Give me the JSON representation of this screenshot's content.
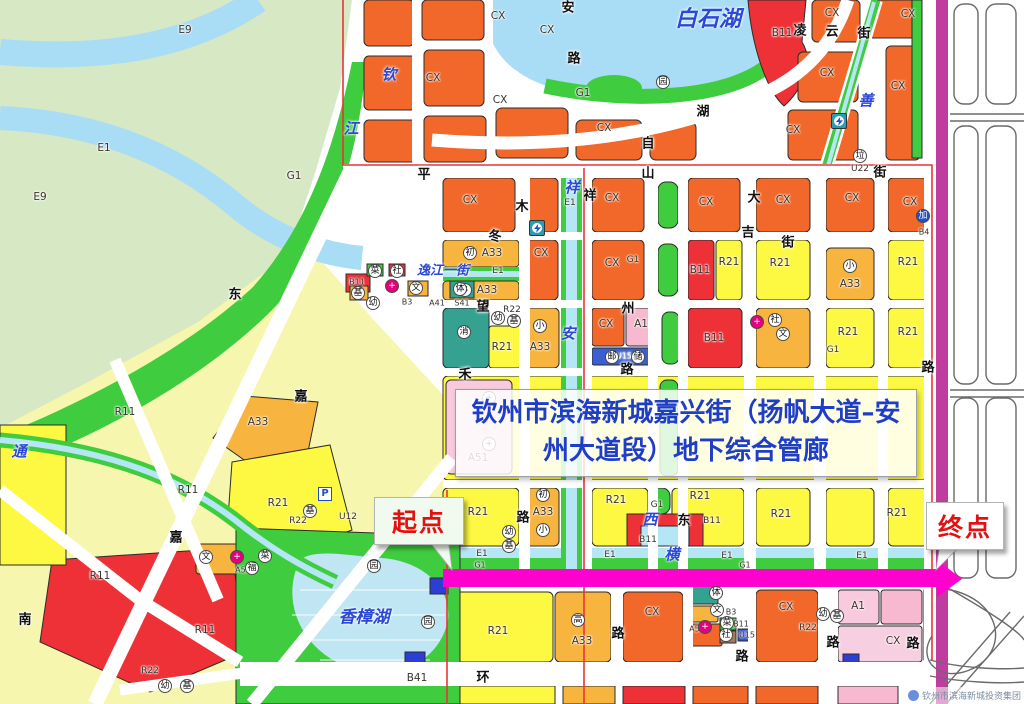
{
  "title": {
    "text": "钦州市滨海新城嘉兴街（扬帆大道–安州大道段）地下综合管廊"
  },
  "callouts": {
    "start": "起点",
    "end": "终点"
  },
  "watermark": {
    "text": "钦州市滨海新城投资集团"
  },
  "colors": {
    "corridor": "#ff00ce",
    "boundary": "#e93434",
    "arterial_road": "#c03da0",
    "commercial_cx": "#f2682a",
    "residential_r21": "#fdf842",
    "residential_r11": "#f6f6ae",
    "school_a33": "#f7b43e",
    "business_b11": "#ee3137",
    "medical_a1": "#f6b9d0",
    "green_g1": "#3fcd3f",
    "water_e1": "#a9dcf5",
    "title_text": "#1f3ec8",
    "callout_text": "#e21212"
  },
  "map": {
    "water_labels": [
      {
        "t": "白石湖",
        "x": 708,
        "y": 17,
        "s": 22
      },
      {
        "t": "香樟湖",
        "x": 364,
        "y": 615,
        "s": 17
      },
      {
        "t": "逸江一街",
        "x": 443,
        "y": 269,
        "s": 13
      },
      {
        "t": "钦",
        "x": 389,
        "y": 74
      },
      {
        "t": "江",
        "x": 351,
        "y": 128
      },
      {
        "t": "祥",
        "x": 572,
        "y": 187
      },
      {
        "t": "安",
        "x": 568,
        "y": 333
      },
      {
        "t": "横",
        "x": 672,
        "y": 554
      },
      {
        "t": "西",
        "x": 650,
        "y": 519
      },
      {
        "t": "通",
        "x": 19,
        "y": 451
      },
      {
        "t": "善",
        "x": 866,
        "y": 100
      }
    ],
    "street_labels": [
      {
        "t": "平",
        "x": 424,
        "y": 173
      },
      {
        "t": "山",
        "x": 648,
        "y": 172
      },
      {
        "t": "街",
        "x": 880,
        "y": 171
      },
      {
        "t": "凌",
        "x": 800,
        "y": 29
      },
      {
        "t": "云",
        "x": 832,
        "y": 30
      },
      {
        "t": "街",
        "x": 864,
        "y": 32
      },
      {
        "t": "大",
        "x": 754,
        "y": 196
      },
      {
        "t": "吉",
        "x": 748,
        "y": 231
      },
      {
        "t": "街",
        "x": 788,
        "y": 241
      },
      {
        "t": "冬",
        "x": 495,
        "y": 235
      },
      {
        "t": "木",
        "x": 522,
        "y": 205
      },
      {
        "t": "望",
        "x": 483,
        "y": 305
      },
      {
        "t": "州",
        "x": 628,
        "y": 307
      },
      {
        "t": "路",
        "x": 627,
        "y": 368
      },
      {
        "t": "禾",
        "x": 465,
        "y": 373
      },
      {
        "t": "湖",
        "x": 703,
        "y": 110
      },
      {
        "t": "自",
        "x": 648,
        "y": 142
      },
      {
        "t": "安",
        "x": 568,
        "y": 6
      },
      {
        "t": "路",
        "x": 574,
        "y": 57
      },
      {
        "t": "环",
        "x": 483,
        "y": 676
      },
      {
        "t": "路",
        "x": 742,
        "y": 655
      },
      {
        "t": "路",
        "x": 833,
        "y": 641
      },
      {
        "t": "路",
        "x": 913,
        "y": 642
      },
      {
        "t": "路",
        "x": 618,
        "y": 632
      },
      {
        "t": "路",
        "x": 523,
        "y": 516
      },
      {
        "t": "东",
        "x": 684,
        "y": 519
      },
      {
        "t": "南",
        "x": 25,
        "y": 618
      },
      {
        "t": "嘉",
        "x": 301,
        "y": 395
      },
      {
        "t": "嘉",
        "x": 176,
        "y": 536
      },
      {
        "t": "东",
        "x": 235,
        "y": 293
      },
      {
        "t": "路",
        "x": 928,
        "y": 366
      },
      {
        "t": "祥",
        "x": 590,
        "y": 194
      }
    ],
    "zone_labels": [
      {
        "t": "E9",
        "x": 185,
        "y": 30
      },
      {
        "t": "E1",
        "x": 104,
        "y": 148
      },
      {
        "t": "E9",
        "x": 40,
        "y": 197
      },
      {
        "t": "CX",
        "x": 498,
        "y": 16
      },
      {
        "t": "CX",
        "x": 547,
        "y": 30
      },
      {
        "t": "CX",
        "x": 433,
        "y": 78
      },
      {
        "t": "CX",
        "x": 500,
        "y": 100
      },
      {
        "t": "CX",
        "x": 604,
        "y": 128
      },
      {
        "t": "CX",
        "x": 832,
        "y": 13
      },
      {
        "t": "CX",
        "x": 908,
        "y": 14
      },
      {
        "t": "CX",
        "x": 827,
        "y": 73
      },
      {
        "t": "CX",
        "x": 898,
        "y": 86
      },
      {
        "t": "CX",
        "x": 793,
        "y": 130
      },
      {
        "t": "B11",
        "x": 782,
        "y": 33
      },
      {
        "t": "CX",
        "x": 470,
        "y": 200
      },
      {
        "t": "CX",
        "x": 612,
        "y": 198
      },
      {
        "t": "CX",
        "x": 706,
        "y": 202
      },
      {
        "t": "CX",
        "x": 783,
        "y": 200
      },
      {
        "t": "CX",
        "x": 852,
        "y": 198
      },
      {
        "t": "CX",
        "x": 910,
        "y": 202
      },
      {
        "t": "A33",
        "x": 492,
        "y": 253
      },
      {
        "t": "E1",
        "x": 498,
        "y": 271,
        "s": 9
      },
      {
        "t": "A33",
        "x": 487,
        "y": 290
      },
      {
        "t": "CX",
        "x": 541,
        "y": 253
      },
      {
        "t": "G1",
        "x": 633,
        "y": 260,
        "s": 9
      },
      {
        "t": "CX",
        "x": 612,
        "y": 263
      },
      {
        "t": "B11",
        "x": 700,
        "y": 270
      },
      {
        "t": "R21",
        "x": 729,
        "y": 262
      },
      {
        "t": "R21",
        "x": 780,
        "y": 263
      },
      {
        "t": "A33",
        "x": 850,
        "y": 284
      },
      {
        "t": "R21",
        "x": 908,
        "y": 262
      },
      {
        "t": "R22",
        "x": 512,
        "y": 310,
        "s": 9
      },
      {
        "t": "R21",
        "x": 502,
        "y": 347
      },
      {
        "t": "A33",
        "x": 540,
        "y": 347
      },
      {
        "t": "CX",
        "x": 606,
        "y": 324
      },
      {
        "t": "A1",
        "x": 641,
        "y": 324
      },
      {
        "t": "U15",
        "x": 624,
        "y": 356,
        "c": "#fff",
        "s": 8
      },
      {
        "t": "B11",
        "x": 714,
        "y": 338
      },
      {
        "t": "R21",
        "x": 848,
        "y": 332
      },
      {
        "t": "G1",
        "x": 833,
        "y": 350,
        "s": 9
      },
      {
        "t": "R21",
        "x": 908,
        "y": 332
      },
      {
        "t": "A51",
        "x": 478,
        "y": 458
      },
      {
        "t": "R21",
        "x": 478,
        "y": 512
      },
      {
        "t": "A33",
        "x": 543,
        "y": 512
      },
      {
        "t": "R21",
        "x": 616,
        "y": 500
      },
      {
        "t": "R21",
        "x": 700,
        "y": 496
      },
      {
        "t": "G1",
        "x": 657,
        "y": 505,
        "s": 9
      },
      {
        "t": "B11",
        "x": 648,
        "y": 540,
        "s": 9
      },
      {
        "t": "B11",
        "x": 712,
        "y": 521,
        "s": 9
      },
      {
        "t": "R21",
        "x": 781,
        "y": 514
      },
      {
        "t": "R21",
        "x": 897,
        "y": 513
      },
      {
        "t": "R21",
        "x": 498,
        "y": 631
      },
      {
        "t": "A33",
        "x": 582,
        "y": 641
      },
      {
        "t": "CX",
        "x": 652,
        "y": 612
      },
      {
        "t": "CX",
        "x": 786,
        "y": 607
      },
      {
        "t": "A52",
        "x": 697,
        "y": 629,
        "s": 8
      },
      {
        "t": "B3",
        "x": 731,
        "y": 612,
        "s": 8
      },
      {
        "t": "B11",
        "x": 741,
        "y": 624,
        "s": 8
      },
      {
        "t": "U15",
        "x": 747,
        "y": 635,
        "s": 8
      },
      {
        "t": "R22",
        "x": 808,
        "y": 628,
        "s": 9
      },
      {
        "t": "A1",
        "x": 858,
        "y": 606
      },
      {
        "t": "CX",
        "x": 893,
        "y": 641
      },
      {
        "t": "R11",
        "x": 125,
        "y": 412
      },
      {
        "t": "R11",
        "x": 188,
        "y": 490
      },
      {
        "t": "R11",
        "x": 100,
        "y": 576
      },
      {
        "t": "R11",
        "x": 205,
        "y": 630
      },
      {
        "t": "A33",
        "x": 258,
        "y": 422
      },
      {
        "t": "R21",
        "x": 278,
        "y": 503
      },
      {
        "t": "R22",
        "x": 298,
        "y": 521,
        "s": 9
      },
      {
        "t": "U12",
        "x": 348,
        "y": 517,
        "s": 9
      },
      {
        "t": "R22",
        "x": 150,
        "y": 671,
        "s": 9
      },
      {
        "t": "B41",
        "x": 417,
        "y": 678
      },
      {
        "t": "B11",
        "x": 357,
        "y": 282,
        "s": 8
      },
      {
        "t": "B3",
        "x": 407,
        "y": 302,
        "s": 8
      },
      {
        "t": "A41",
        "x": 437,
        "y": 303,
        "s": 8
      },
      {
        "t": "S41",
        "x": 462,
        "y": 303,
        "s": 8
      },
      {
        "t": "A52",
        "x": 243,
        "y": 570,
        "s": 8
      },
      {
        "t": "G1",
        "x": 294,
        "y": 176
      },
      {
        "t": "G1",
        "x": 583,
        "y": 93
      },
      {
        "t": "B4",
        "x": 924,
        "y": 232,
        "s": 8
      },
      {
        "t": "E1",
        "x": 482,
        "y": 554,
        "s": 9
      },
      {
        "t": "E1",
        "x": 610,
        "y": 555,
        "s": 9
      },
      {
        "t": "E1",
        "x": 727,
        "y": 556,
        "s": 9
      },
      {
        "t": "E1",
        "x": 862,
        "y": 556,
        "s": 9
      },
      {
        "t": "G1",
        "x": 480,
        "y": 565,
        "s": 8
      },
      {
        "t": "G1",
        "x": 745,
        "y": 565,
        "s": 8
      },
      {
        "t": "E1",
        "x": 570,
        "y": 203,
        "s": 9
      },
      {
        "t": "U22",
        "x": 860,
        "y": 169,
        "s": 9
      }
    ],
    "circle_icons": [
      {
        "t": "初",
        "x": 470,
        "y": 253
      },
      {
        "t": "B",
        "x": 465,
        "y": 290
      },
      {
        "t": "幼",
        "x": 498,
        "y": 318
      },
      {
        "t": "基",
        "x": 514,
        "y": 321
      },
      {
        "t": "消",
        "x": 464,
        "y": 332
      },
      {
        "t": "小",
        "x": 540,
        "y": 326
      },
      {
        "t": "邮",
        "x": 612,
        "y": 357
      },
      {
        "t": "储",
        "x": 638,
        "y": 357
      },
      {
        "t": "小",
        "x": 850,
        "y": 266
      },
      {
        "t": "社",
        "x": 775,
        "y": 320
      },
      {
        "t": "文",
        "x": 783,
        "y": 334
      },
      {
        "t": "+",
        "x": 489,
        "y": 398
      },
      {
        "t": "+",
        "x": 489,
        "y": 444
      },
      {
        "t": "初",
        "x": 543,
        "y": 495
      },
      {
        "t": "小",
        "x": 543,
        "y": 530
      },
      {
        "t": "幼",
        "x": 509,
        "y": 532
      },
      {
        "t": "基",
        "x": 509,
        "y": 546
      },
      {
        "t": "高",
        "x": 578,
        "y": 620
      },
      {
        "t": "垃",
        "x": 860,
        "y": 156
      },
      {
        "t": "园",
        "x": 663,
        "y": 82
      },
      {
        "t": "园",
        "x": 374,
        "y": 566
      },
      {
        "t": "园",
        "x": 428,
        "y": 622
      },
      {
        "t": "幼",
        "x": 823,
        "y": 614
      },
      {
        "t": "基",
        "x": 837,
        "y": 616
      },
      {
        "t": "体",
        "x": 716,
        "y": 593
      },
      {
        "t": "文",
        "x": 717,
        "y": 610
      },
      {
        "t": "菜",
        "x": 727,
        "y": 623
      },
      {
        "t": "社",
        "x": 726,
        "y": 635
      },
      {
        "t": "文",
        "x": 206,
        "y": 557
      },
      {
        "t": "福",
        "x": 252,
        "y": 568
      },
      {
        "t": "菜",
        "x": 265,
        "y": 556
      },
      {
        "t": "基",
        "x": 310,
        "y": 511
      },
      {
        "t": "幼",
        "x": 165,
        "y": 686
      },
      {
        "t": "基",
        "x": 187,
        "y": 686
      },
      {
        "t": "菜",
        "x": 375,
        "y": 271
      },
      {
        "t": "社",
        "x": 397,
        "y": 271
      },
      {
        "t": "文",
        "x": 416,
        "y": 288
      },
      {
        "t": "体",
        "x": 460,
        "y": 289
      },
      {
        "t": "幼",
        "x": 373,
        "y": 303
      },
      {
        "t": "基",
        "x": 358,
        "y": 293
      },
      {
        "t": "加",
        "x": 923,
        "y": 216,
        "bg": "#2050c8",
        "c": "#fff"
      },
      {
        "t": "+",
        "x": 392,
        "y": 286,
        "bg": "#e6007e",
        "c": "#fff"
      },
      {
        "t": "+",
        "x": 237,
        "y": 557,
        "bg": "#e6007e",
        "c": "#fff"
      },
      {
        "t": "+",
        "x": 705,
        "y": 627,
        "bg": "#e6007e",
        "c": "#fff"
      },
      {
        "t": "+",
        "x": 757,
        "y": 322,
        "bg": "#e6007e",
        "c": "#fff"
      }
    ],
    "bolt_icons": [
      {
        "x": 537,
        "y": 228
      },
      {
        "x": 839,
        "y": 121
      }
    ],
    "p_icons": [
      {
        "t": "P",
        "x": 325,
        "y": 494
      }
    ]
  }
}
